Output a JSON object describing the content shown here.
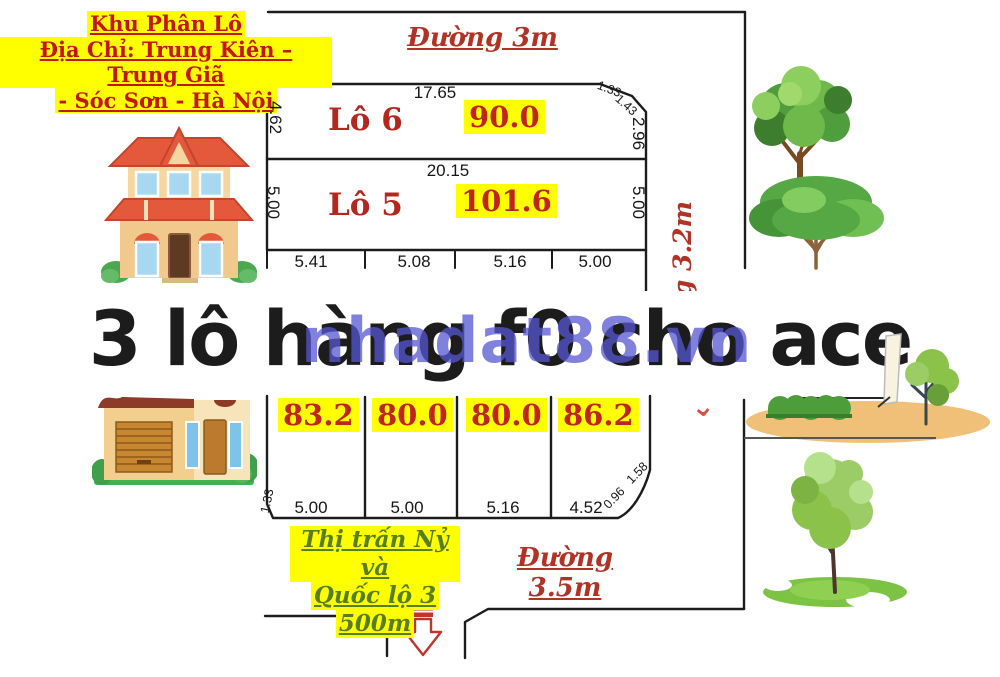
{
  "header": {
    "line1": "Khu Phân Lô",
    "line2": "Địa Chỉ: Trung Kiên – Trung Giã",
    "line3": "- Sóc Sơn - Hà Nội"
  },
  "roads": {
    "top": "Đường 3m",
    "right": "Đường 3.2m",
    "bottom": "Đường 3.5m"
  },
  "landmark": {
    "line1": "Thị trấn Nỷ và",
    "line2": "Quốc lộ 3",
    "line3": "500m"
  },
  "watermark": {
    "main": "3 lô hàng f0 cho ace",
    "site": "nhadat88.vn"
  },
  "upper_lots": {
    "lot6": {
      "name": "Lô 6",
      "area": "90.0"
    },
    "lot5": {
      "name": "Lô 5",
      "area": "101.6"
    }
  },
  "lower_lots": {
    "areas": [
      "83.2",
      "80.0",
      "80.0",
      "86.2"
    ]
  },
  "dims": {
    "top_width": "17.65",
    "lot6_left": "4.62",
    "chamfer_a": "1.33",
    "chamfer_b": "1.43",
    "lot6_right": "2.96",
    "mid_width": "20.15",
    "lot5_left": "5.00",
    "lot5_right": "5.00",
    "rear_widths": [
      "5.41",
      "5.08",
      "5.16",
      "5.00"
    ],
    "front_widths": [
      "5.00",
      "5.00",
      "5.16",
      "4.52"
    ],
    "front_left_chamfer": "1.33",
    "front_right_chamfer_a": "0.96",
    "front_right_chamfer_b": "1.58"
  },
  "marks": {
    "chevron": "⌄"
  },
  "colors": {
    "accent_red": "#c0241c",
    "highlight_yellow": "#ffff00",
    "watermark_blue": "#5656d2",
    "text_green": "#567d1e"
  }
}
